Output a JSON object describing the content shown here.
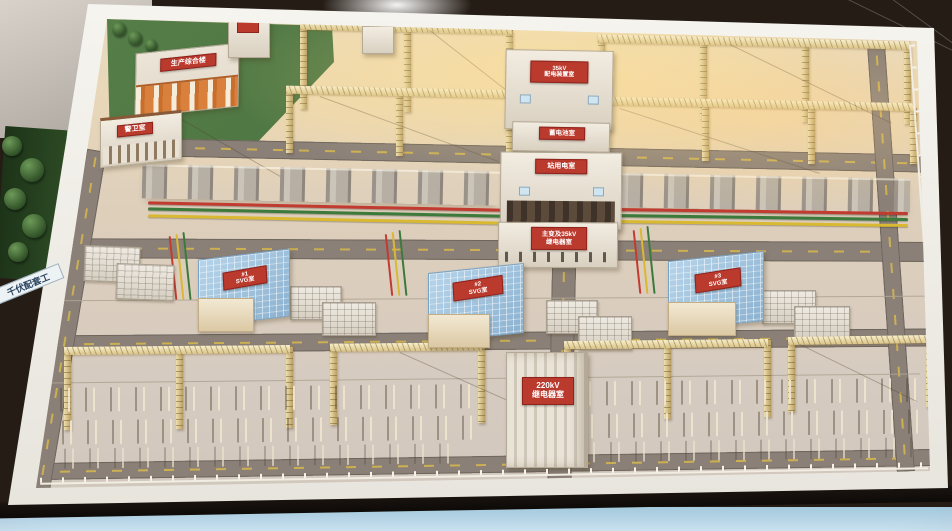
{
  "signs": {
    "plaque": "千伏配套工",
    "admin": "生产综合楼",
    "guard": "警卫室",
    "switchgear_line1": "35kV",
    "switchgear_line2": "配电装置室",
    "battery": "蓄电池室",
    "station_power": "站用电室",
    "mt_relay_line1": "主变及35kV",
    "mt_relay_line2": "继电器室",
    "svg1_line1": "#1",
    "svg1_line2": "SVG室",
    "svg2_line1": "#2",
    "svg2_line2": "SVG室",
    "svg3_line1": "#3",
    "svg3_line2": "SVG室",
    "relay220_line1": "220kV",
    "relay220_line2": "继电器室"
  },
  "colors": {
    "sign_red": "#bb3a2e",
    "roof_blue": "#a9cbe4",
    "lattice_gold": "#e9d7a2",
    "grass_green": "#4b7440",
    "busbar_red": "#c23b31",
    "busbar_green": "#3c7a3c",
    "busbar_yellow": "#d9b832"
  }
}
